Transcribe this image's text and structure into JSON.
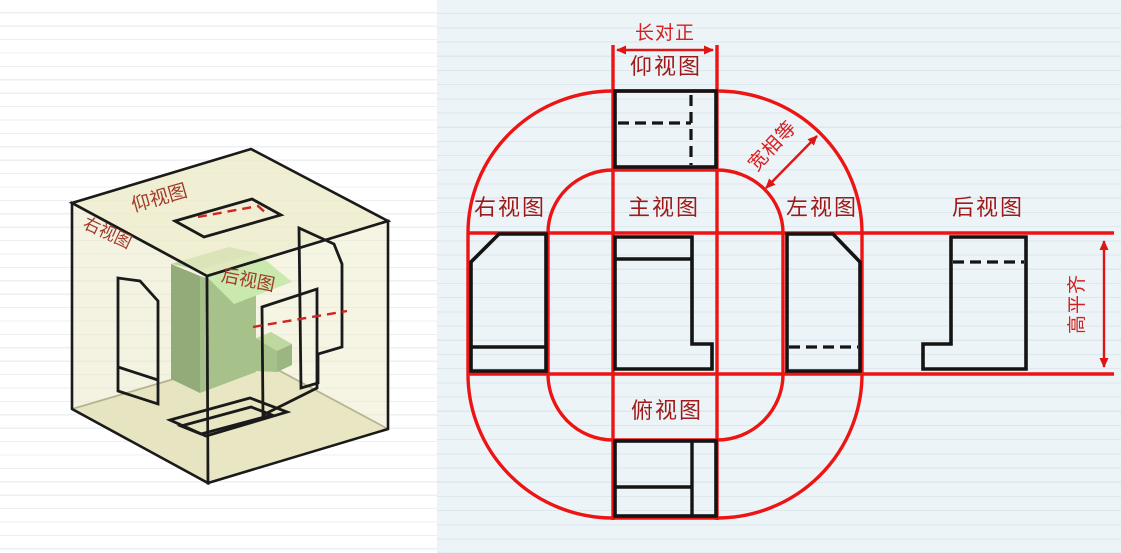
{
  "figure": {
    "title_hint": "six orthographic views unfolding diagram",
    "views": {
      "front": "主视图",
      "top": "俯视图",
      "bottom": "仰视图",
      "left": "左视图",
      "right": "右视图",
      "rear": "后视图"
    },
    "annotations": {
      "length_alignment": "长对正",
      "width_equality": "宽相等",
      "height_alignment": "高平齐"
    },
    "iso": {
      "top_face_label": "仰视图",
      "left_face_label": "右视图",
      "object_face_label": "后视图"
    },
    "colors": {
      "projection_red": "#ed1414",
      "annotation_red": "#d32021",
      "label_dark_red": "#9e1a1a",
      "drawing_black": "#141414",
      "cube_face_yellow": "#eceac6",
      "object_green": "#6fa05c",
      "object_green_bright": "#ade99d",
      "paper_right": "#edf4f7",
      "paper_left": "#ffffff"
    }
  }
}
